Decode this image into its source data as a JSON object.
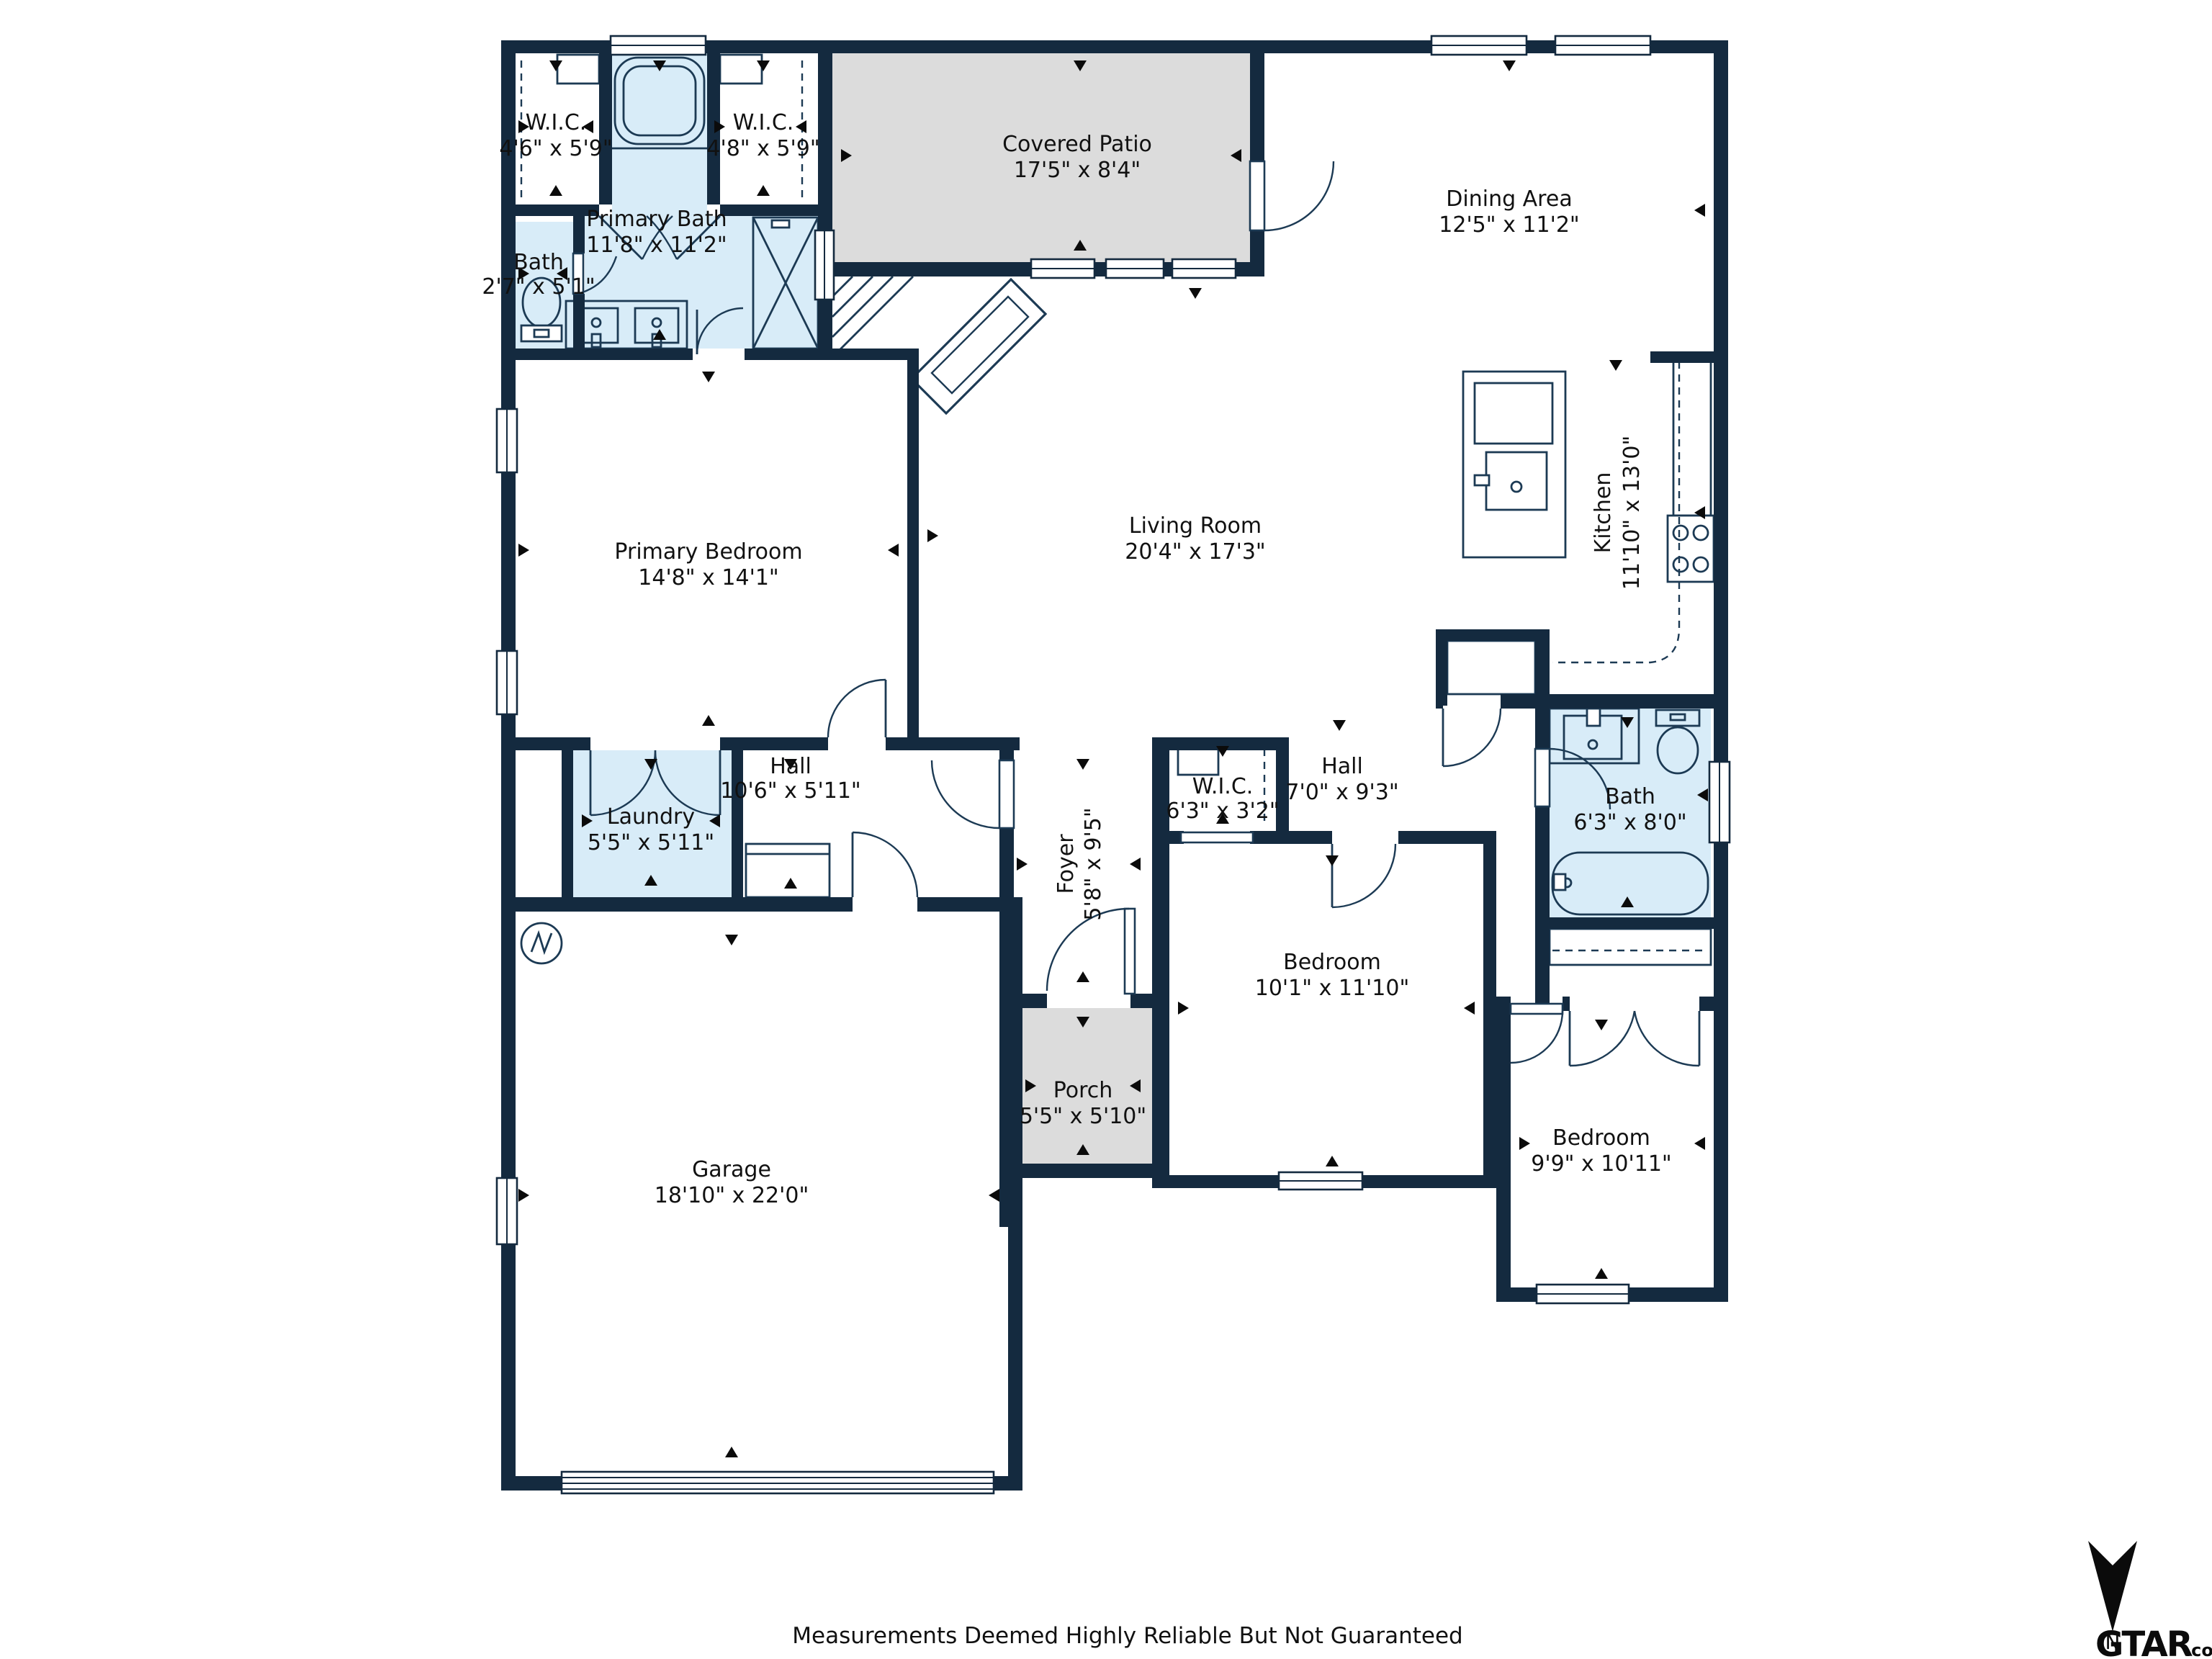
{
  "title": "Floor plan",
  "colors": {
    "wall": "#142A3F",
    "wet_room_fill": "#D8ECF8",
    "outdoor_fill": "#DCDCDC",
    "text": "#111111",
    "fixture_line": "#1C3A54"
  },
  "rooms": {
    "wic_left": {
      "name": "W.I.C.",
      "dims": "4'6\" x 5'9\""
    },
    "primary_bath": {
      "name": "Primary Bath",
      "dims": "11'8\" x 11'2\""
    },
    "wic_right": {
      "name": "W.I.C.",
      "dims": "4'8\" x 5'9\""
    },
    "covered_patio": {
      "name": "Covered Patio",
      "dims": "17'5\" x 8'4\""
    },
    "dining": {
      "name": "Dining Area",
      "dims": "12'5\" x 11'2\""
    },
    "bath_small": {
      "name": "Bath",
      "dims": "2'7\" x 5'1\""
    },
    "primary_bedroom": {
      "name": "Primary Bedroom",
      "dims": "14'8\" x 14'1\""
    },
    "living": {
      "name": "Living Room",
      "dims": "20'4\" x 17'3\""
    },
    "kitchen": {
      "name": "Kitchen",
      "dims": "11'10\" x 13'0\""
    },
    "hall1": {
      "name": "Hall",
      "dims": "10'6\" x 5'11\""
    },
    "laundry": {
      "name": "Laundry",
      "dims": "5'5\" x 5'11\""
    },
    "wic_small": {
      "name": "W.I.C.",
      "dims": "6'3\" x 3'2\""
    },
    "hall2": {
      "name": "Hall",
      "dims": "7'0\" x 9'3\""
    },
    "bath2": {
      "name": "Bath",
      "dims": "6'3\" x 8'0\""
    },
    "foyer": {
      "name": "Foyer",
      "dims": "5'8\" x 9'5\""
    },
    "bedroom1": {
      "name": "Bedroom",
      "dims": "10'1\" x 11'10\""
    },
    "porch": {
      "name": "Porch",
      "dims": "5'5\" x 5'10\""
    },
    "garage": {
      "name": "Garage",
      "dims": "18'10\" x 22'0\""
    },
    "bedroom2": {
      "name": "Bedroom",
      "dims": "9'9\" x 10'11\""
    }
  },
  "footer": {
    "disclaimer": "Measurements Deemed Highly Reliable But Not Guaranteed"
  },
  "compass": {
    "label": "N"
  },
  "logo": {
    "text": "GTAR",
    "suffix": ".com"
  }
}
